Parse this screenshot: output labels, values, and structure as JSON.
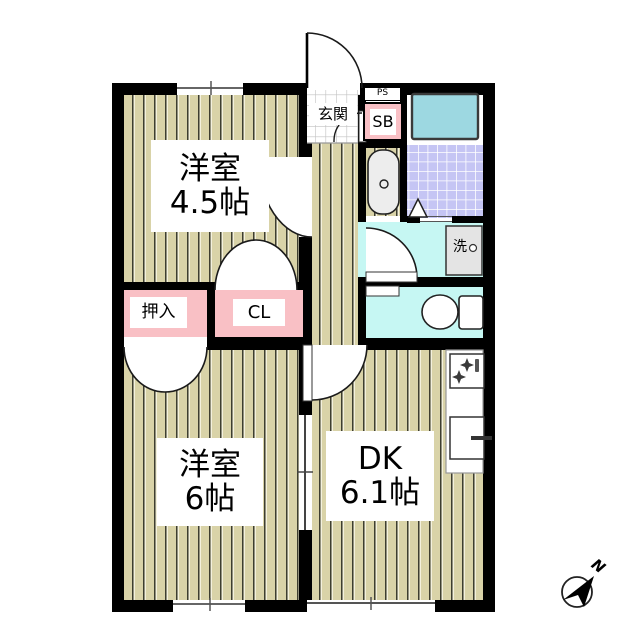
{
  "plan_title": "2DK apartment floor plan",
  "rooms": {
    "western_room_small": {
      "name": "洋室",
      "size": "4.5帖"
    },
    "western_room_large": {
      "name": "洋室",
      "size": "6帖"
    },
    "dining_kitchen": {
      "name": "DK",
      "size": "6.1帖"
    },
    "entrance": {
      "label": "玄関"
    },
    "pipe_space": {
      "label": "PS"
    },
    "shoe_box": {
      "label": "SB"
    },
    "closet_oshiire": {
      "label": "押入"
    },
    "closet_cl": {
      "label": "CL"
    },
    "washer": {
      "label": "洗"
    }
  },
  "compass": {
    "label": "N"
  },
  "colors": {
    "wall": "#000000",
    "wood_floor": "#d9d3a8",
    "closet_pink": "#f9c0c5",
    "wet_area_cyan": "#c6f7f3",
    "bathtub_teal": "#9dd8e1",
    "bath_tile_lavender": "#c5c5f4",
    "washer_gray": "#e4e4e4"
  }
}
